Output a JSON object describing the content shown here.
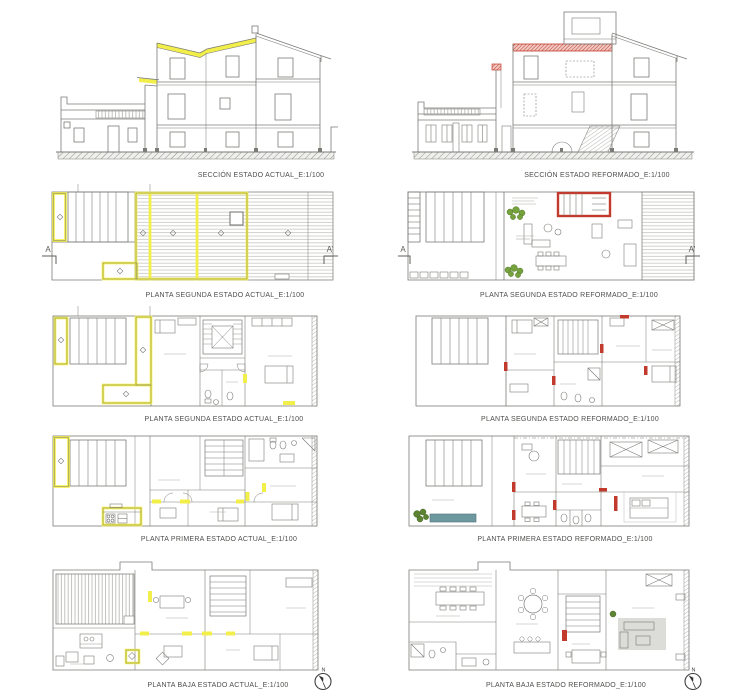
{
  "sheet": {
    "description": "Architectural comparison sheet: current state (yellow) vs reformed state (red)",
    "colors": {
      "line": "#7b7b78",
      "highlight_actual_yellow": "#f3ef4a",
      "highlight_reformed_red": "#c23a2c",
      "vegetation_green": "#5d8432",
      "water_teal": "#6d98a0"
    }
  },
  "section_markers": {
    "left": "A",
    "right": "A'"
  },
  "north_arrow": {
    "label": "N"
  },
  "panels": [
    {
      "id": "seccion-estado-actual",
      "caption": "SECCIÓN ESTADO ACTUAL_E:1/100"
    },
    {
      "id": "seccion-estado-reformado",
      "caption": "SECCIÓN ESTADO REFORMADO_E:1/100"
    },
    {
      "id": "planta-segunda-cubierta-estado-actual",
      "caption": "PLANTA SEGUNDA ESTADO ACTUAL_E:1/100"
    },
    {
      "id": "planta-segunda-cubierta-estado-reformado",
      "caption": "PLANTA SEGUNDA ESTADO REFORMADO_E:1/100"
    },
    {
      "id": "planta-segunda-estado-actual",
      "caption": "PLANTA SEGUNDA ESTADO ACTUAL_E:1/100"
    },
    {
      "id": "planta-segunda-estado-reformado",
      "caption": "PLANTA SEGUNDA ESTADO REFORMADO_E:1/100"
    },
    {
      "id": "planta-primera-estado-actual",
      "caption": "PLANTA PRIMERA ESTADO ACTUAL_E:1/100"
    },
    {
      "id": "planta-primera-estado-reformado",
      "caption": "PLANTA PRIMERA ESTADO REFORMADO_E:1/100"
    },
    {
      "id": "planta-baja-estado-actual",
      "caption": "PLANTA BAJA ESTADO ACTUAL_E:1/100"
    },
    {
      "id": "planta-baja-estado-reformado",
      "caption": "PLANTA BAJA ESTADO REFORMADO_E:1/100"
    }
  ]
}
